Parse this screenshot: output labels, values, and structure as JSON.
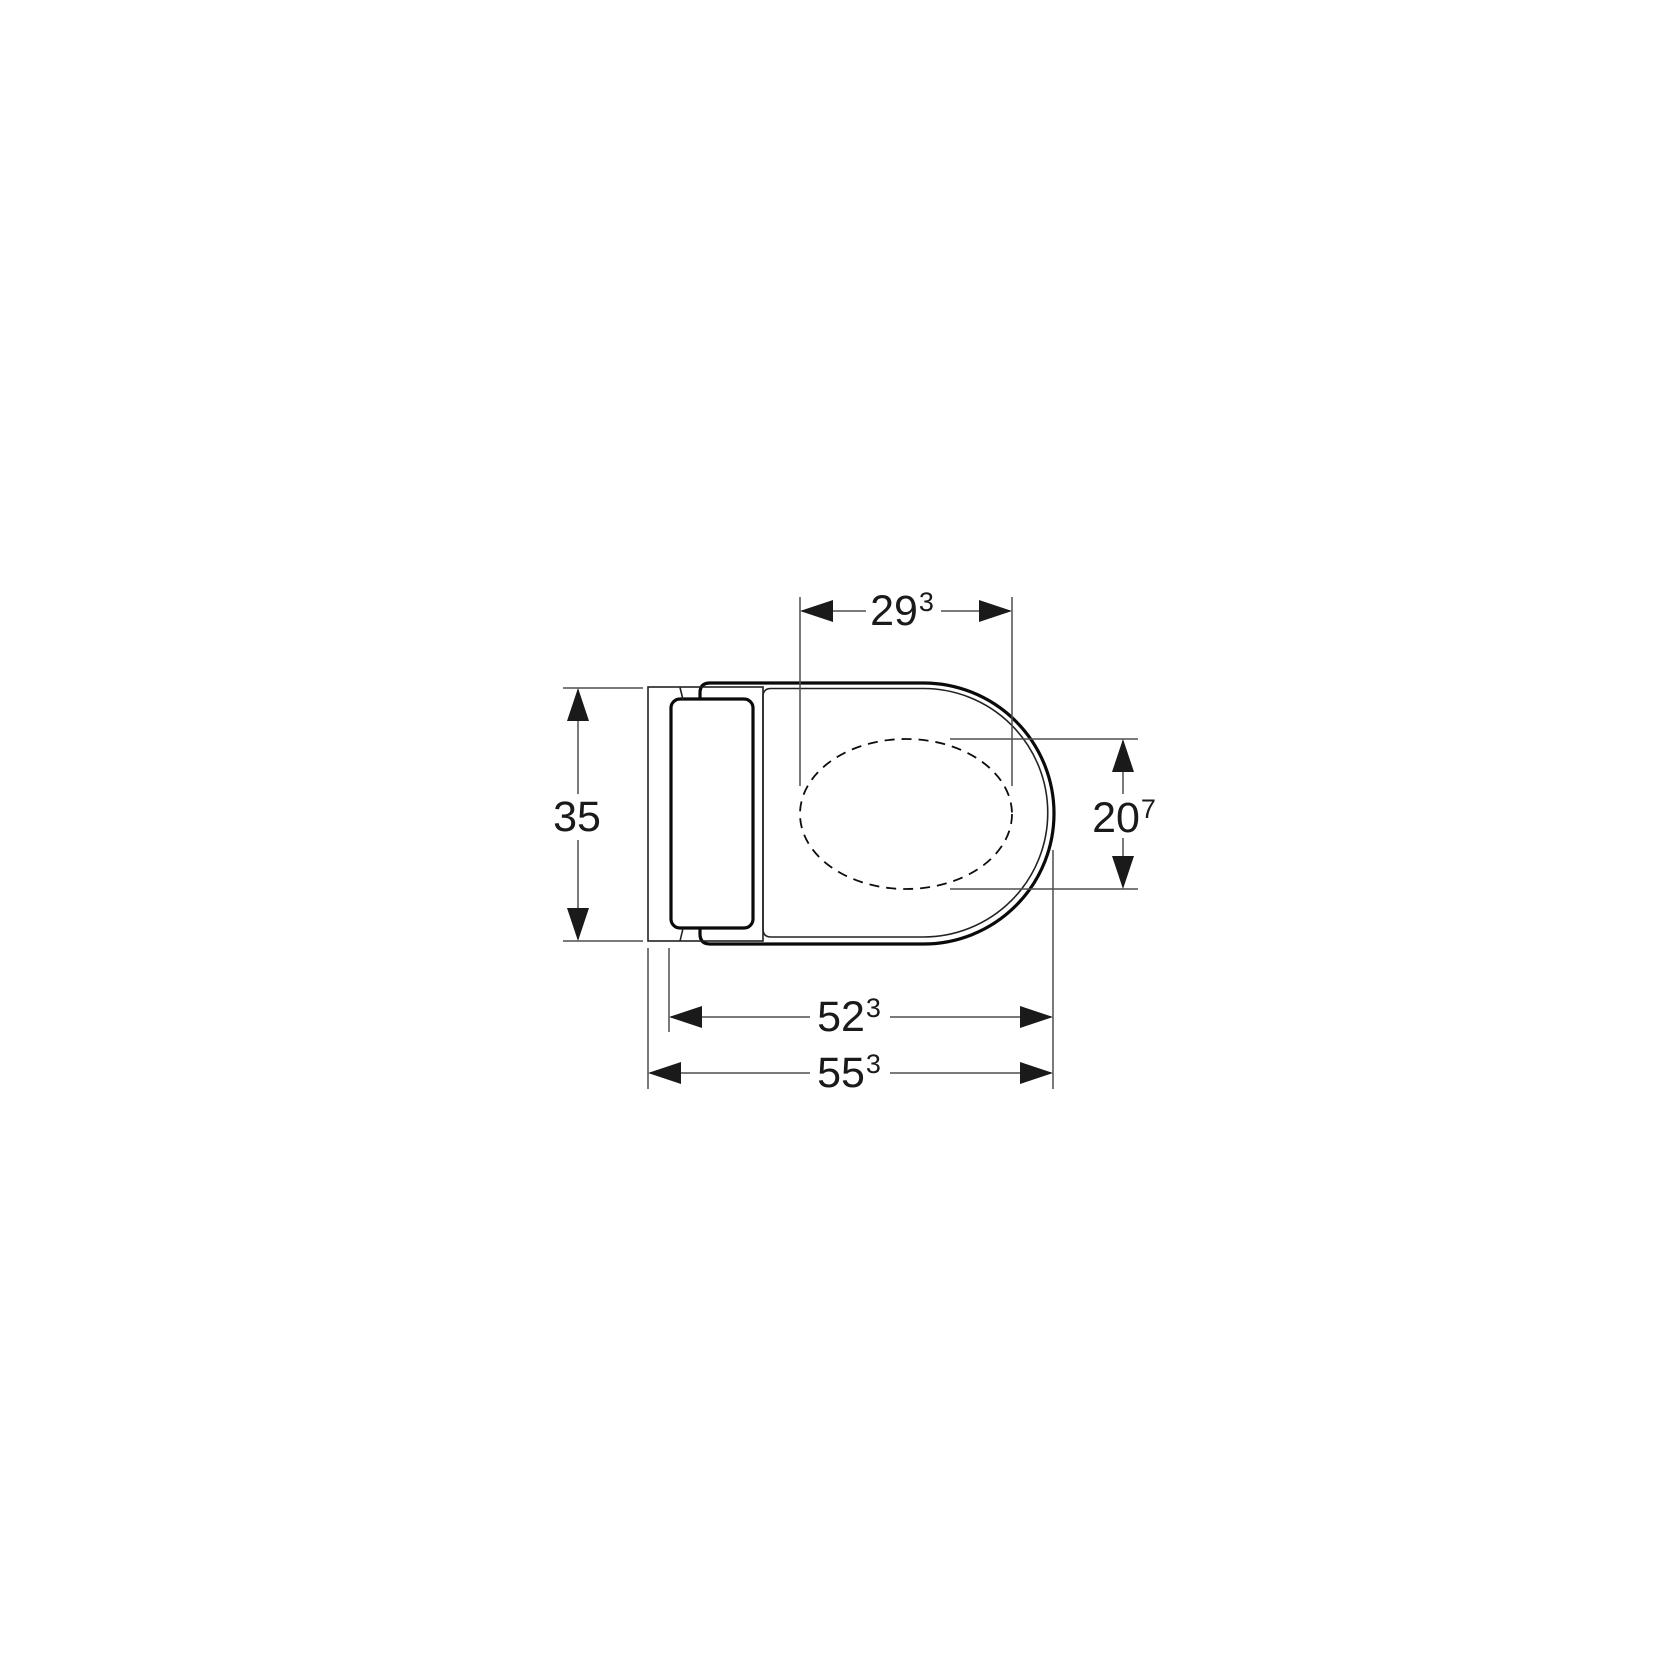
{
  "drawing": {
    "description": "Technical top-view dimensional drawing of a wall-hung WC with flush plate and seat, dashed inner bowl outline",
    "units": "cm",
    "colors": {
      "background": "#ffffff",
      "product_outline": "#0a0a0a",
      "dimension_lines": "#4f4f4f",
      "dimension_text": "#1a1a1a"
    },
    "parts": [
      "wall-plate",
      "flush-plate",
      "bowl-outline",
      "seat-outline",
      "inner-bowl-dashed"
    ],
    "dimensions": {
      "inner_width_top": {
        "main": "29",
        "sup": "3"
      },
      "wall_width_left": {
        "main": "35",
        "sup": ""
      },
      "inner_depth_right": {
        "main": "20",
        "sup": "7"
      },
      "bowl_depth_bottom": {
        "main": "52",
        "sup": "3"
      },
      "total_depth_bottom": {
        "main": "55",
        "sup": "3"
      }
    }
  }
}
